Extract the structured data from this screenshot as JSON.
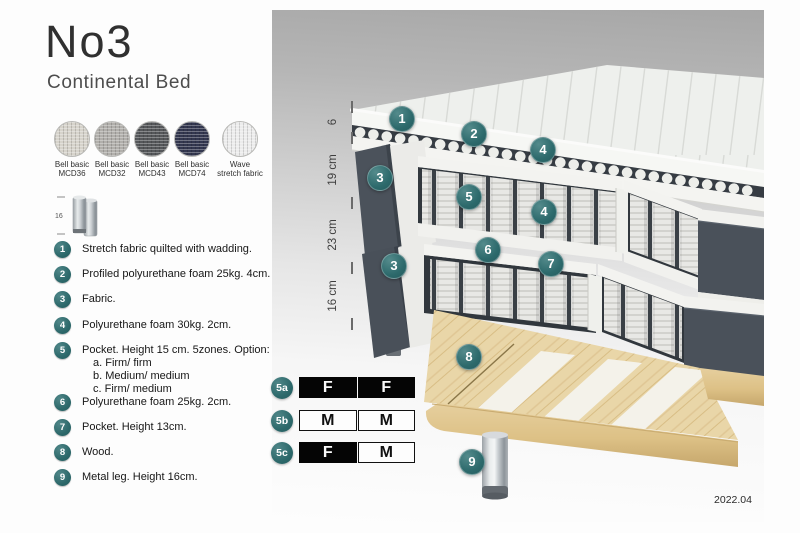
{
  "header": {
    "title": "No3",
    "subtitle": "Continental Bed"
  },
  "swatches": {
    "items": [
      {
        "line1": "Bell basic",
        "line2": "MCD36",
        "color": "#d6d3cb"
      },
      {
        "line1": "Bell basic",
        "line2": "MCD32",
        "color": "#b1afab"
      },
      {
        "line1": "Bell basic",
        "line2": "MCD43",
        "color": "#55575a"
      },
      {
        "line1": "Bell basic",
        "line2": "MCD74",
        "color": "#33374f"
      },
      {
        "line1": "Wave",
        "line2": "stretch fabric",
        "color": "#ececec"
      }
    ]
  },
  "leg_icon": {
    "dimension": "16"
  },
  "legend": {
    "items": [
      {
        "num": "1",
        "text": "Stretch fabric quilted with wadding."
      },
      {
        "num": "2",
        "text": "Profiled polyurethane foam 25kg. 4cm."
      },
      {
        "num": "3",
        "text": "Fabric."
      },
      {
        "num": "4",
        "text": "Polyurethane foam 30kg. 2cm."
      },
      {
        "num": "5",
        "text": "Pocket. Height 15 cm. 5zones. Option:",
        "options": [
          "a. Firm/ firm",
          "b. Medium/ medium",
          "c. Firm/ medium"
        ]
      },
      {
        "num": "6",
        "text": "Polyurethane foam 25kg. 2cm."
      },
      {
        "num": "7",
        "text": "Pocket. Height 13cm."
      },
      {
        "num": "8",
        "text": "Wood."
      },
      {
        "num": "9",
        "text": "Metal leg. Height 16cm."
      }
    ]
  },
  "diagram": {
    "dimensions": [
      "6",
      "19 cm",
      "23 cm",
      "16 cm"
    ],
    "callouts": [
      "1",
      "2",
      "4",
      "3",
      "5",
      "4",
      "6",
      "7",
      "3",
      "8",
      "9"
    ],
    "firmness": [
      {
        "label": "5a",
        "cells": [
          {
            "text": "F",
            "variant": "dark"
          },
          {
            "text": "F",
            "variant": "dark"
          }
        ]
      },
      {
        "label": "5b",
        "cells": [
          {
            "text": "M",
            "variant": "light"
          },
          {
            "text": "M",
            "variant": "light"
          }
        ]
      },
      {
        "label": "5c",
        "cells": [
          {
            "text": "F",
            "variant": "dark"
          },
          {
            "text": "M",
            "variant": "light"
          }
        ]
      }
    ],
    "version": "2022.04"
  },
  "colors": {
    "accent_teal": "#2e6c6e",
    "bed_fabric_gray": "#4a515a",
    "wood": "#e9d6a8",
    "panel_gray_top": "#a7a7a7"
  }
}
